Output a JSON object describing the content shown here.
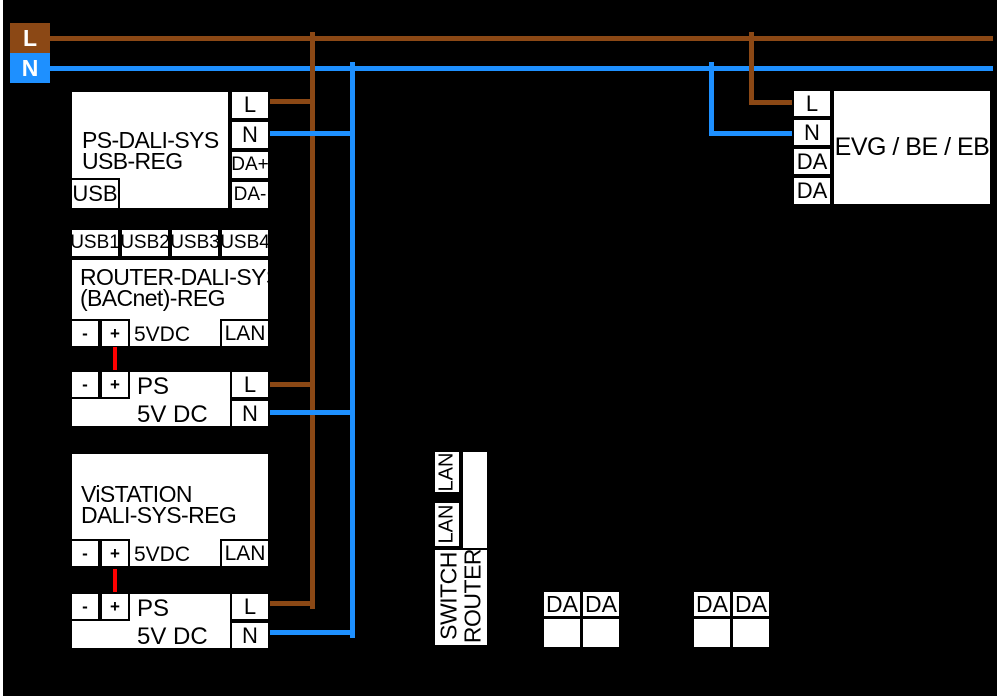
{
  "diagram_title": "DALI-SYS wiring diagram",
  "colors": {
    "background": "#000000",
    "page_margin": "#ffffff",
    "box_fill": "#ffffff",
    "box_border": "#000000",
    "line_l_brown": "#8B4815",
    "line_n_blue": "#1E90FF",
    "jumper_red": "#FF0000"
  },
  "power_bus": {
    "l_label": "L",
    "n_label": "N"
  },
  "components": {
    "ps_dali_sys_usb_reg": {
      "title": [
        "PS-DALI-SYS",
        "USB-REG"
      ],
      "bottom_port": "USB",
      "right_terminals": [
        "L",
        "N",
        "DA+",
        "DA-"
      ]
    },
    "router_dali_sys": {
      "top_ports": [
        "USB1",
        "USB2",
        "USB3",
        "USB4"
      ],
      "title": [
        "ROUTER-DALI-SYS",
        "(BACnet)-REG"
      ],
      "dc_terminals": [
        "-",
        "+"
      ],
      "dc_label": "5VDC",
      "lan_port": "LAN"
    },
    "ps_top": {
      "dc_terminals": [
        "-",
        "+"
      ],
      "name": "PS",
      "voltage": "5V DC",
      "right_terminals": [
        "L",
        "N"
      ]
    },
    "vistation": {
      "title": [
        "ViSTATION",
        "DALI-SYS-REG"
      ],
      "dc_terminals": [
        "-",
        "+"
      ],
      "dc_label": "5VDC",
      "lan_port": "LAN"
    },
    "ps_bottom": {
      "dc_terminals": [
        "-",
        "+"
      ],
      "name": "PS",
      "voltage": "5V DC",
      "right_terminals": [
        "L",
        "N"
      ]
    },
    "switch_router": {
      "title": [
        "SWITCH",
        "ROUTER"
      ],
      "lan_ports": [
        "LAN",
        "LAN"
      ]
    },
    "evg": {
      "title": "EVG / BE / EB",
      "left_terminals": [
        "L",
        "N",
        "DA",
        "DA"
      ]
    },
    "dali_device_1": {
      "terminals": [
        "DA",
        "DA"
      ]
    },
    "dali_device_2": {
      "terminals": [
        "DA",
        "DA"
      ]
    }
  }
}
